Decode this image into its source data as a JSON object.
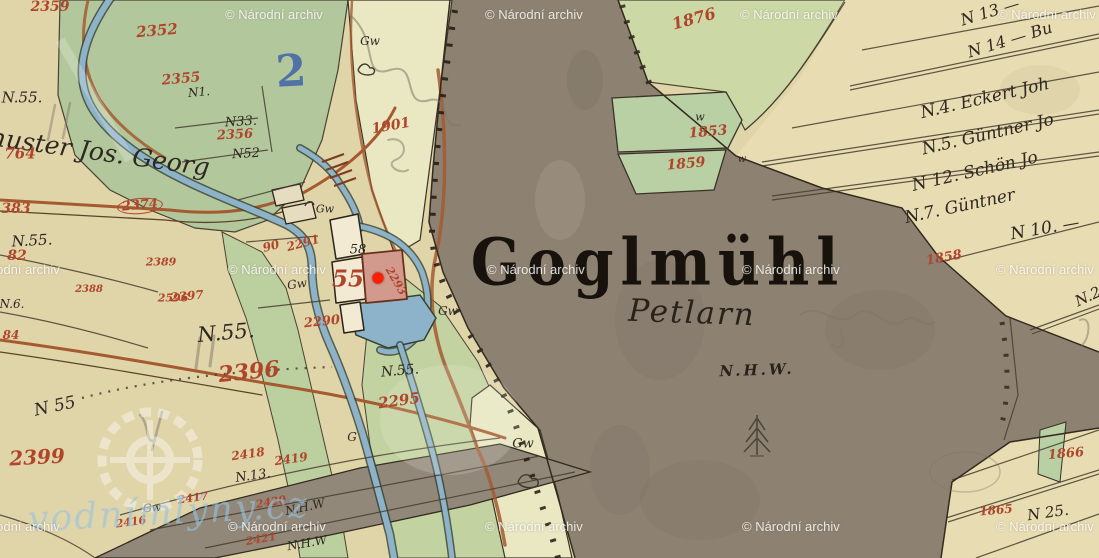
{
  "map": {
    "title": "Goglmühl",
    "settlement_note": "Petlarn",
    "elevation_note": "N.H.W.",
    "labels": [
      {
        "text": "N.55.",
        "x": 22,
        "y": 98,
        "size": 15,
        "kind": "ink",
        "rot": 0
      },
      {
        "text": "huster Jos. Georg",
        "x": 100,
        "y": 152,
        "size": 25,
        "kind": "ink",
        "rot": 8
      },
      {
        "text": "N.55.",
        "x": 32,
        "y": 241,
        "size": 15,
        "kind": "ink",
        "rot": -3
      },
      {
        "text": "N.6.",
        "x": 12,
        "y": 304,
        "size": 12,
        "kind": "ink",
        "rot": 0
      },
      {
        "text": "N.55.",
        "x": 226,
        "y": 333,
        "size": 21,
        "kind": "ink",
        "rot": -5
      },
      {
        "text": "N.55.",
        "x": 400,
        "y": 371,
        "size": 14,
        "kind": "ink",
        "rot": -5
      },
      {
        "text": "N 55",
        "x": 55,
        "y": 407,
        "size": 17,
        "kind": "ink",
        "rot": -12
      },
      {
        "text": "N1.",
        "x": 199,
        "y": 92,
        "size": 12,
        "kind": "ink",
        "rot": -5
      },
      {
        "text": "N33.",
        "x": 241,
        "y": 122,
        "size": 13,
        "kind": "ink",
        "rot": -3
      },
      {
        "text": "N52",
        "x": 246,
        "y": 154,
        "size": 13,
        "kind": "ink",
        "rot": -3
      },
      {
        "text": "N.13.",
        "x": 253,
        "y": 476,
        "size": 13,
        "kind": "ink",
        "rot": -8
      },
      {
        "text": "N.H.W",
        "x": 305,
        "y": 507,
        "size": 12,
        "kind": "ink",
        "rot": -12
      },
      {
        "text": "N.H.W",
        "x": 307,
        "y": 543,
        "size": 12,
        "kind": "ink",
        "rot": -10
      },
      {
        "text": "58",
        "x": 358,
        "y": 250,
        "size": 13,
        "kind": "ink",
        "rot": 0
      },
      {
        "text": "G",
        "x": 352,
        "y": 437,
        "size": 12,
        "kind": "ink",
        "rot": 0
      },
      {
        "text": "Gw",
        "x": 370,
        "y": 41,
        "size": 12,
        "kind": "ink",
        "rot": 0
      },
      {
        "text": "Gw",
        "x": 325,
        "y": 209,
        "size": 11,
        "kind": "ink",
        "rot": 0
      },
      {
        "text": "Gw",
        "x": 297,
        "y": 284,
        "size": 12,
        "kind": "ink",
        "rot": -8
      },
      {
        "text": "Gw",
        "x": 448,
        "y": 311,
        "size": 12,
        "kind": "ink",
        "rot": 0
      },
      {
        "text": "Gw",
        "x": 523,
        "y": 444,
        "size": 13,
        "kind": "ink",
        "rot": 0
      },
      {
        "text": "Gw",
        "x": 152,
        "y": 508,
        "size": 11,
        "kind": "ink",
        "rot": -5
      },
      {
        "text": "w",
        "x": 700,
        "y": 117,
        "size": 11,
        "kind": "ink",
        "rot": 0
      },
      {
        "text": "w",
        "x": 742,
        "y": 160,
        "size": 10,
        "kind": "ink",
        "rot": 0
      },
      {
        "text": "N 13 —",
        "x": 990,
        "y": 12,
        "size": 16,
        "kind": "ink",
        "rot": -17
      },
      {
        "text": "N 14 — Bu",
        "x": 1010,
        "y": 40,
        "size": 16,
        "kind": "ink",
        "rot": -17
      },
      {
        "text": "N.4. Eckert Joh",
        "x": 985,
        "y": 99,
        "size": 17,
        "kind": "ink",
        "rot": -13
      },
      {
        "text": "N.5. Güntner Jo",
        "x": 988,
        "y": 135,
        "size": 17,
        "kind": "ink",
        "rot": -13
      },
      {
        "text": "N 12. Schön Jo",
        "x": 975,
        "y": 172,
        "size": 17,
        "kind": "ink",
        "rot": -13
      },
      {
        "text": "N.7. Güntner",
        "x": 960,
        "y": 207,
        "size": 17,
        "kind": "ink",
        "rot": -12
      },
      {
        "text": "N 10. —",
        "x": 1045,
        "y": 229,
        "size": 17,
        "kind": "ink",
        "rot": -10
      },
      {
        "text": "N.2",
        "x": 1088,
        "y": 297,
        "size": 15,
        "kind": "ink",
        "rot": -25
      },
      {
        "text": "N 25.",
        "x": 1048,
        "y": 513,
        "size": 15,
        "kind": "ink",
        "rot": -8
      },
      {
        "text": "2359",
        "x": 50,
        "y": 7,
        "size": 14,
        "kind": "red",
        "rot": 0
      },
      {
        "text": "2352",
        "x": 157,
        "y": 31,
        "size": 15,
        "kind": "red",
        "rot": -5
      },
      {
        "text": "2355",
        "x": 181,
        "y": 79,
        "size": 14,
        "kind": "red",
        "rot": -5
      },
      {
        "text": "2356",
        "x": 235,
        "y": 135,
        "size": 13,
        "kind": "red",
        "rot": -3
      },
      {
        "text": "1901",
        "x": 391,
        "y": 126,
        "size": 14,
        "kind": "red",
        "rot": -10
      },
      {
        "text": "1876",
        "x": 694,
        "y": 19,
        "size": 16,
        "kind": "red",
        "rot": -15
      },
      {
        "text": "1853",
        "x": 708,
        "y": 132,
        "size": 14,
        "kind": "red",
        "rot": -5
      },
      {
        "text": "1859",
        "x": 686,
        "y": 164,
        "size": 14,
        "kind": "red",
        "rot": -5
      },
      {
        "text": "1858",
        "x": 944,
        "y": 258,
        "size": 13,
        "kind": "red",
        "rot": -10
      },
      {
        "text": "1866",
        "x": 1066,
        "y": 454,
        "size": 13,
        "kind": "red",
        "rot": -5
      },
      {
        "text": "1865",
        "x": 996,
        "y": 510,
        "size": 12,
        "kind": "red",
        "rot": -5
      },
      {
        "text": "764",
        "x": 20,
        "y": 154,
        "size": 15,
        "kind": "red",
        "rot": 0
      },
      {
        "text": "383",
        "x": 16,
        "y": 209,
        "size": 14,
        "kind": "red",
        "rot": 0
      },
      {
        "text": "2374",
        "x": 140,
        "y": 206,
        "size": 13,
        "kind": "red circled",
        "rot": -5
      },
      {
        "text": "82",
        "x": 17,
        "y": 256,
        "size": 14,
        "kind": "red",
        "rot": 0
      },
      {
        "text": "2389",
        "x": 161,
        "y": 262,
        "size": 11,
        "kind": "red",
        "rot": 0
      },
      {
        "text": "2596",
        "x": 173,
        "y": 298,
        "size": 11,
        "kind": "red",
        "rot": 0
      },
      {
        "text": "2388",
        "x": 89,
        "y": 290,
        "size": 10,
        "kind": "red",
        "rot": 0
      },
      {
        "text": "84",
        "x": 11,
        "y": 335,
        "size": 12,
        "kind": "red",
        "rot": 0
      },
      {
        "text": "2397",
        "x": 187,
        "y": 296,
        "size": 12,
        "kind": "red",
        "rot": -5
      },
      {
        "text": "2396",
        "x": 249,
        "y": 372,
        "size": 22,
        "kind": "red",
        "rot": -6
      },
      {
        "text": "2290",
        "x": 322,
        "y": 322,
        "size": 13,
        "kind": "red",
        "rot": -6
      },
      {
        "text": "2291",
        "x": 303,
        "y": 243,
        "size": 12,
        "kind": "red",
        "rot": -15
      },
      {
        "text": "90",
        "x": 271,
        "y": 246,
        "size": 12,
        "kind": "red",
        "rot": -15
      },
      {
        "text": "2295",
        "x": 399,
        "y": 401,
        "size": 15,
        "kind": "red",
        "rot": -8
      },
      {
        "text": "2293",
        "x": 396,
        "y": 281,
        "size": 11,
        "kind": "red",
        "rot": 60
      },
      {
        "text": "2399",
        "x": 37,
        "y": 457,
        "size": 20,
        "kind": "red",
        "rot": -3
      },
      {
        "text": "2418",
        "x": 248,
        "y": 454,
        "size": 12,
        "kind": "red",
        "rot": -8
      },
      {
        "text": "2419",
        "x": 291,
        "y": 459,
        "size": 12,
        "kind": "red",
        "rot": -8
      },
      {
        "text": "2420",
        "x": 271,
        "y": 502,
        "size": 11,
        "kind": "red",
        "rot": -10
      },
      {
        "text": "2421",
        "x": 261,
        "y": 539,
        "size": 11,
        "kind": "red",
        "rot": -10
      },
      {
        "text": "2417",
        "x": 193,
        "y": 498,
        "size": 11,
        "kind": "red",
        "rot": -8
      },
      {
        "text": "2416",
        "x": 131,
        "y": 522,
        "size": 11,
        "kind": "red",
        "rot": -8
      },
      {
        "text": "55",
        "x": 348,
        "y": 279,
        "size": 23,
        "kind": "red",
        "rot": 0
      },
      {
        "text": "2",
        "x": 291,
        "y": 72,
        "size": 44,
        "kind": "blue",
        "rot": -3
      }
    ]
  },
  "marker": {
    "x": 378,
    "y": 278,
    "color": "#ff1e00"
  },
  "watermark": {
    "text": "© Národní archiv",
    "color": "#ffffff",
    "positions": [
      [
        225,
        7
      ],
      [
        485,
        7
      ],
      [
        740,
        7
      ],
      [
        998,
        7
      ],
      [
        -38,
        262
      ],
      [
        228,
        262
      ],
      [
        487,
        262
      ],
      [
        742,
        262
      ],
      [
        996,
        262
      ],
      [
        -38,
        519
      ],
      [
        228,
        519
      ],
      [
        485,
        519
      ],
      [
        742,
        519
      ],
      [
        996,
        519
      ]
    ]
  },
  "site_watermark": {
    "text": "vodnímlýny.cz",
    "color": "#a8cade"
  },
  "palette": {
    "parchment": "#e0d4a9",
    "meadow_green": "#b6c99c",
    "pale_field": "#e9e8c2",
    "river_gray": "#8d8272",
    "cream": "#e8dcb2",
    "water_blue": "#8db3ca",
    "road_sienna": "#a55a30",
    "ink_black": "#2e2821",
    "number_red": "#b0452b",
    "pencil_blue": "#3f64a8",
    "marker_red": "#ff1e00"
  }
}
